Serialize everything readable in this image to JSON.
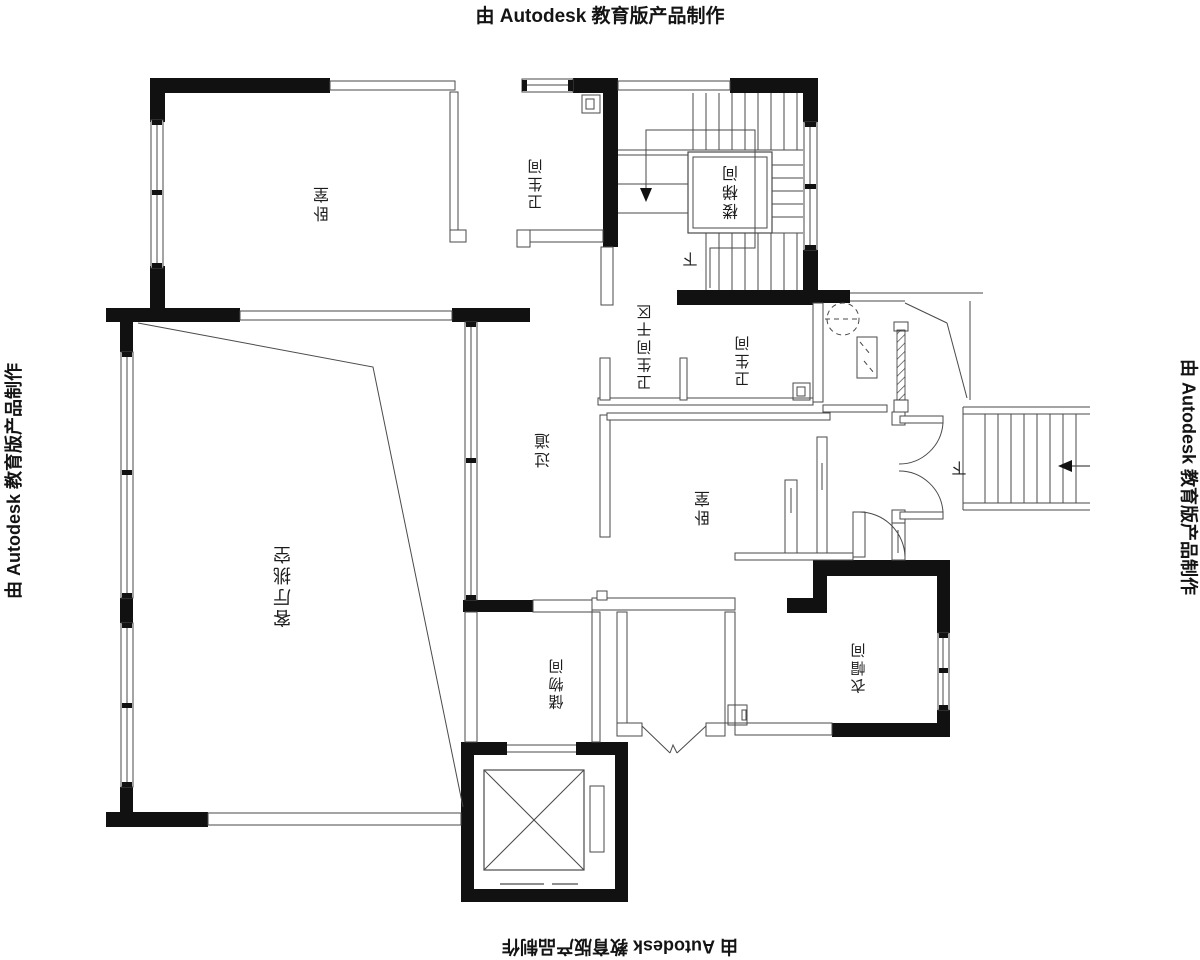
{
  "title": "floor-plan-cad-drawing",
  "watermark": {
    "text": "由 Autodesk 教育版产品制作"
  },
  "colors": {
    "wall": "#111111",
    "line": "#4a4a4a",
    "text": "#1c1c1c"
  },
  "rooms": [
    {
      "id": "bedroom-top",
      "label": "卧室",
      "cx": 321,
      "cy": 204,
      "size": 16
    },
    {
      "id": "bath-top",
      "label": "卫生间",
      "cx": 535,
      "cy": 184,
      "size": 15
    },
    {
      "id": "stairwell",
      "label": "楼梯间",
      "cx": 730,
      "cy": 192,
      "size": 16
    },
    {
      "id": "bath-dry",
      "label": "卫生间干区",
      "cx": 644,
      "cy": 347,
      "size": 15
    },
    {
      "id": "bath-mid",
      "label": "卫生间",
      "cx": 742,
      "cy": 361,
      "size": 15
    },
    {
      "id": "corridor",
      "label": "过道",
      "cx": 542,
      "cy": 450,
      "size": 16
    },
    {
      "id": "bedroom-mid",
      "label": "卧室",
      "cx": 702,
      "cy": 508,
      "size": 16
    },
    {
      "id": "living-void",
      "label": "客厅挑空",
      "cx": 282,
      "cy": 586,
      "size": 18
    },
    {
      "id": "storage",
      "label": "储物间",
      "cx": 556,
      "cy": 684,
      "size": 15
    },
    {
      "id": "cloakroom",
      "label": "衣帽间",
      "cx": 858,
      "cy": 668,
      "size": 15
    }
  ],
  "annotations": [
    {
      "id": "down-stairwell",
      "label": "下",
      "cx": 690,
      "cy": 259,
      "size": 15
    },
    {
      "id": "down-entry",
      "label": "下",
      "cx": 959,
      "cy": 468,
      "size": 15
    }
  ]
}
